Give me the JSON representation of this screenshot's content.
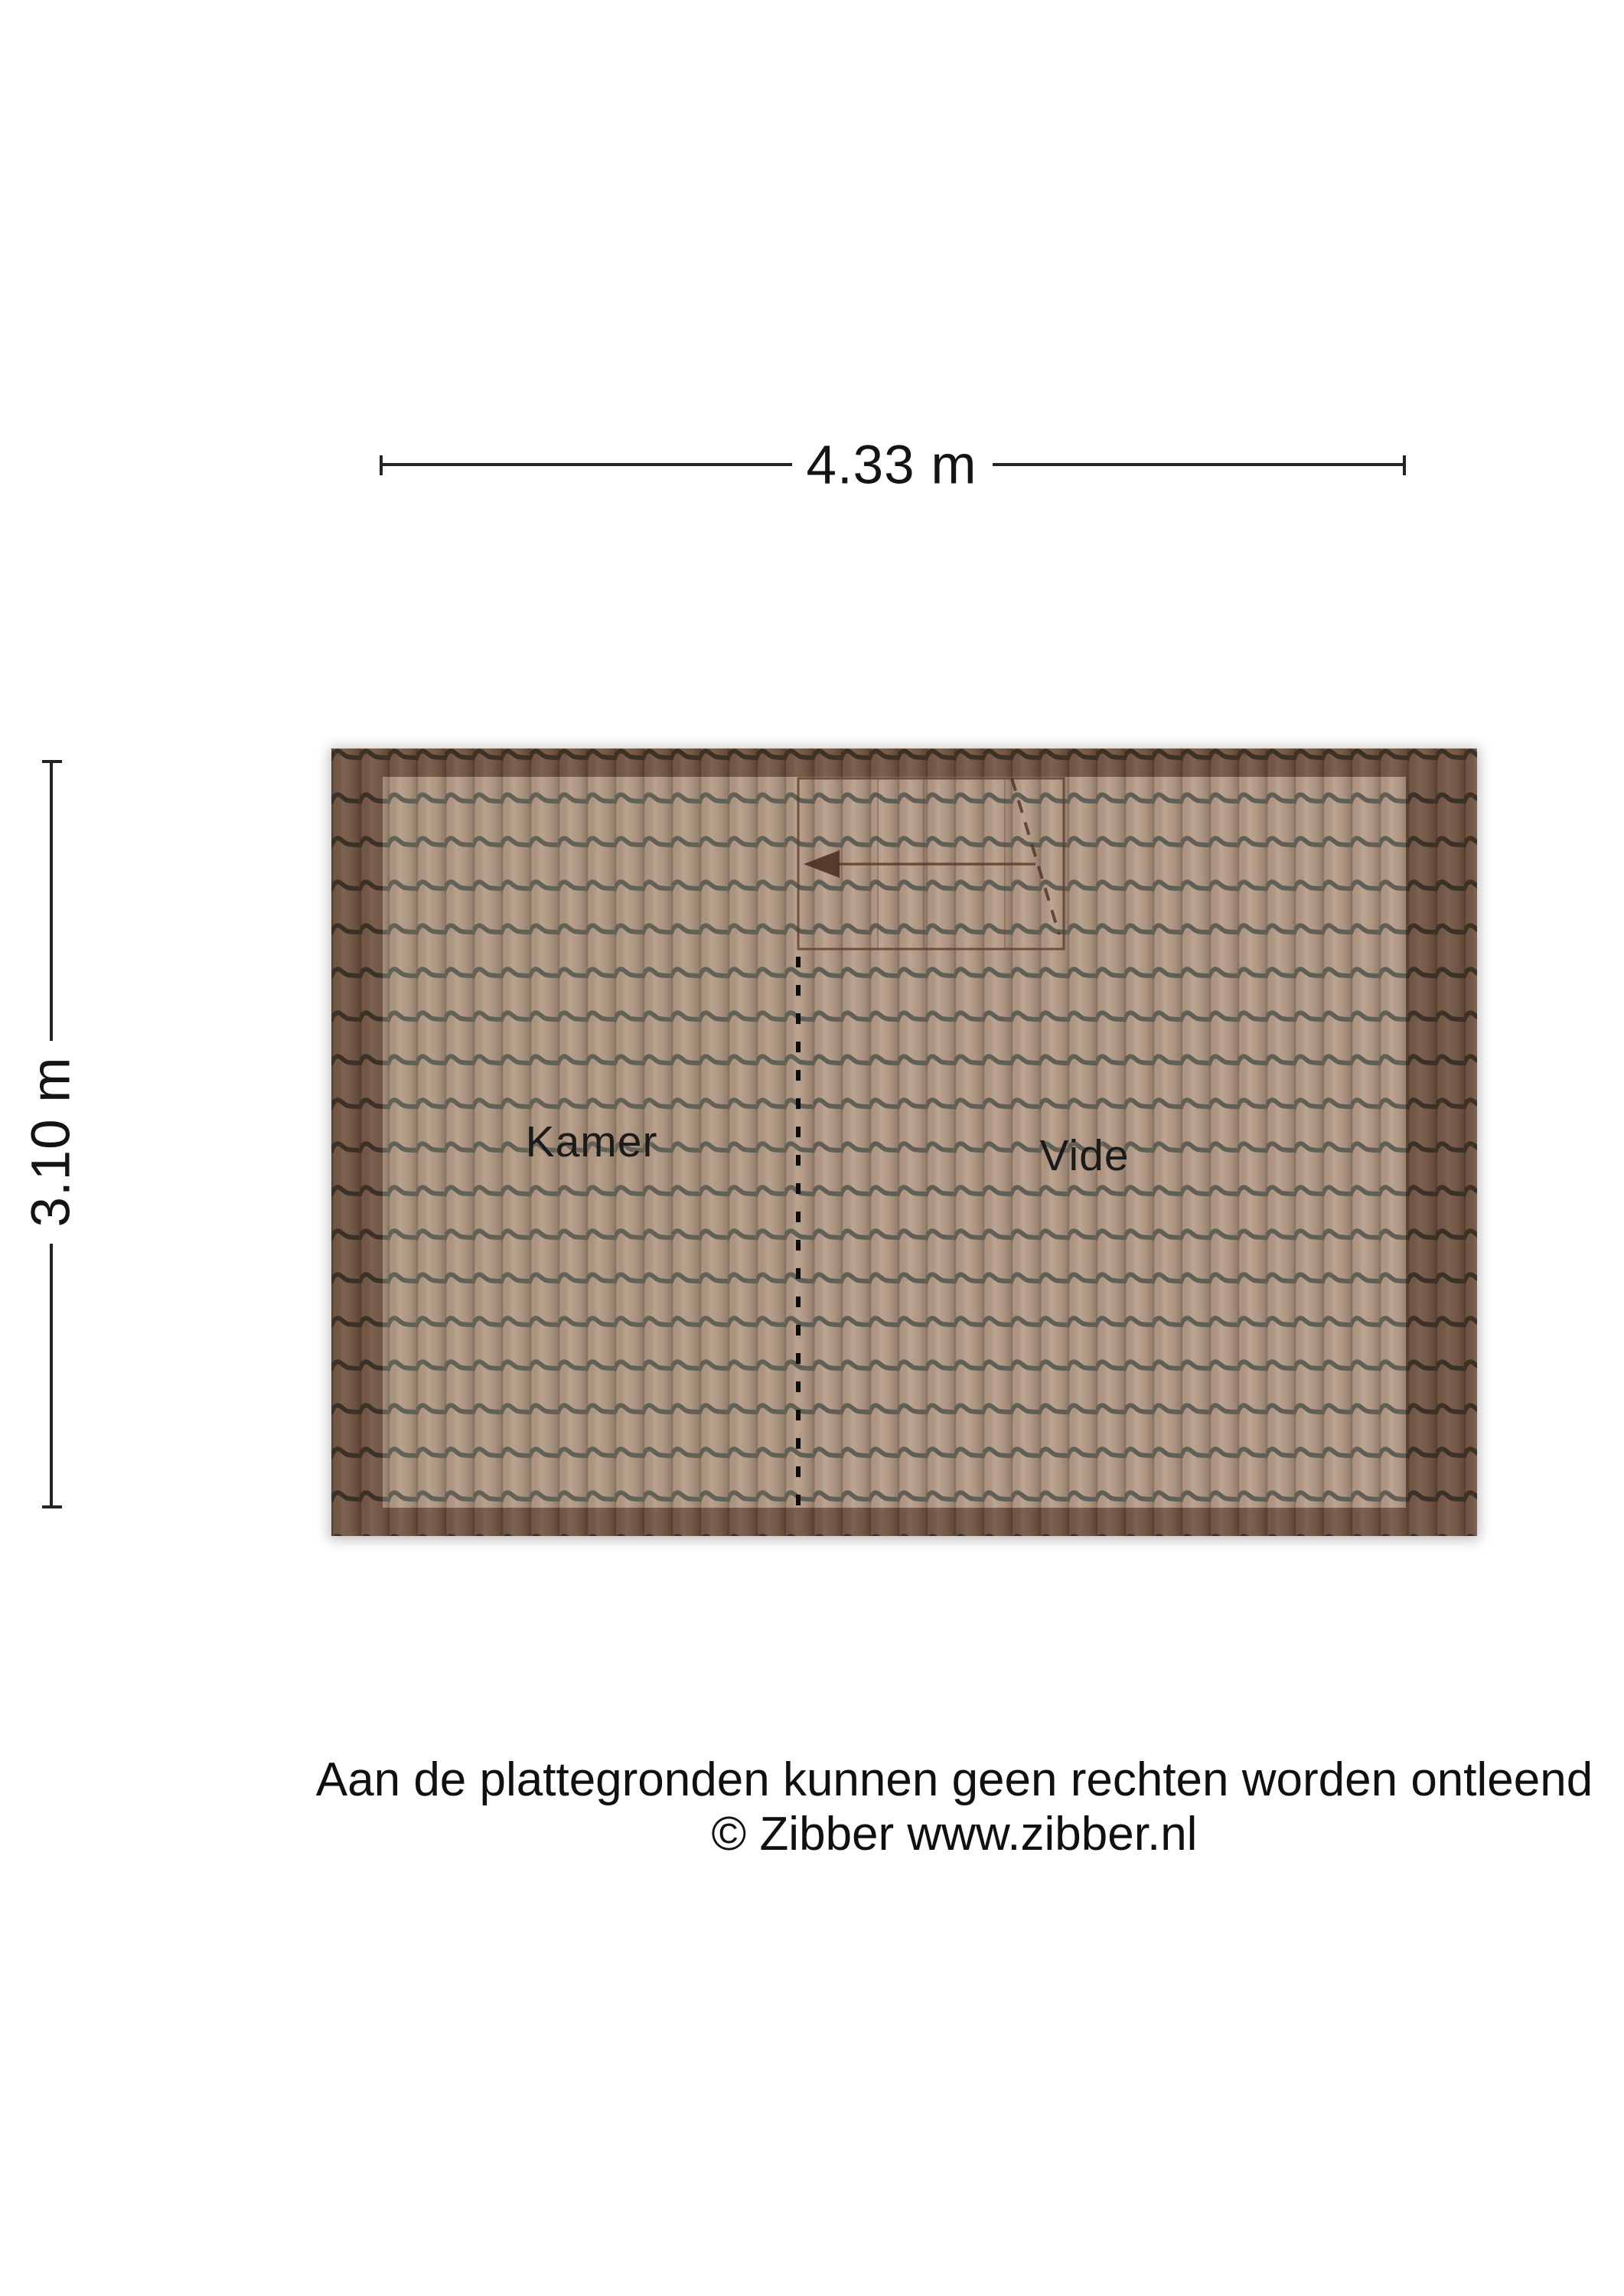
{
  "dimensions": {
    "width": "4.33 m",
    "height": "3.10 m"
  },
  "rooms": {
    "left": "Kamer",
    "right": "Vide"
  },
  "footer": {
    "line1": "Aan de plattegronden kunnen geen rechten worden ontleend",
    "line2": "© Zibber www.zibber.nl"
  },
  "colors": {
    "tile_base": "#a6876f",
    "tile_groove": "#45453b",
    "border_shade": "#2e130a",
    "dimension_line": "#242424",
    "text": "#141414"
  }
}
